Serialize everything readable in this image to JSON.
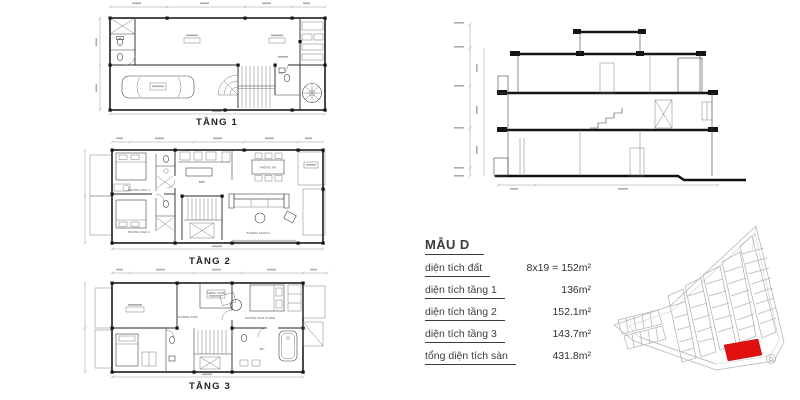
{
  "document": {
    "background": "#ffffff"
  },
  "floor_plans": {
    "floor1": {
      "label": "TẦNG 1"
    },
    "floor2": {
      "label": "TẦNG 2",
      "rooms": {
        "bedroom1": "PHÒNG NGỦ 1",
        "bedroom2": "PHÒNG NGỦ 2",
        "kitchen": "BẾP",
        "dining": "PHÒNG ĂN",
        "living": "PHÒNG KHÁCH"
      }
    },
    "floor3": {
      "label": "TẦNG 3",
      "rooms": {
        "worship": "PHÒNG THỜ",
        "skylight": "GIẾNG TRỜI",
        "master": "PHÒNG NGỦ CHÍNH",
        "wc": "WC"
      }
    }
  },
  "info_panel": {
    "title": "MẪU D",
    "rows": [
      {
        "label": "diện tích đất",
        "value": "8x19 = 152m²"
      },
      {
        "label": "diện tích tầng 1",
        "value": "136m²"
      },
      {
        "label": "diện tích tầng 2",
        "value": "152.1m²"
      },
      {
        "label": "diện tích tầng 3",
        "value": "143.7m²"
      },
      {
        "label": "tổng diện tích sàn",
        "value": "431.8m²"
      }
    ]
  },
  "site_map": {
    "highlight_color": "#e01010"
  },
  "colors": {
    "line": "#1d1d1d",
    "thin_line": "#6b6f71",
    "map_line": "#b4b8bb",
    "text": "#3a3e3a"
  }
}
